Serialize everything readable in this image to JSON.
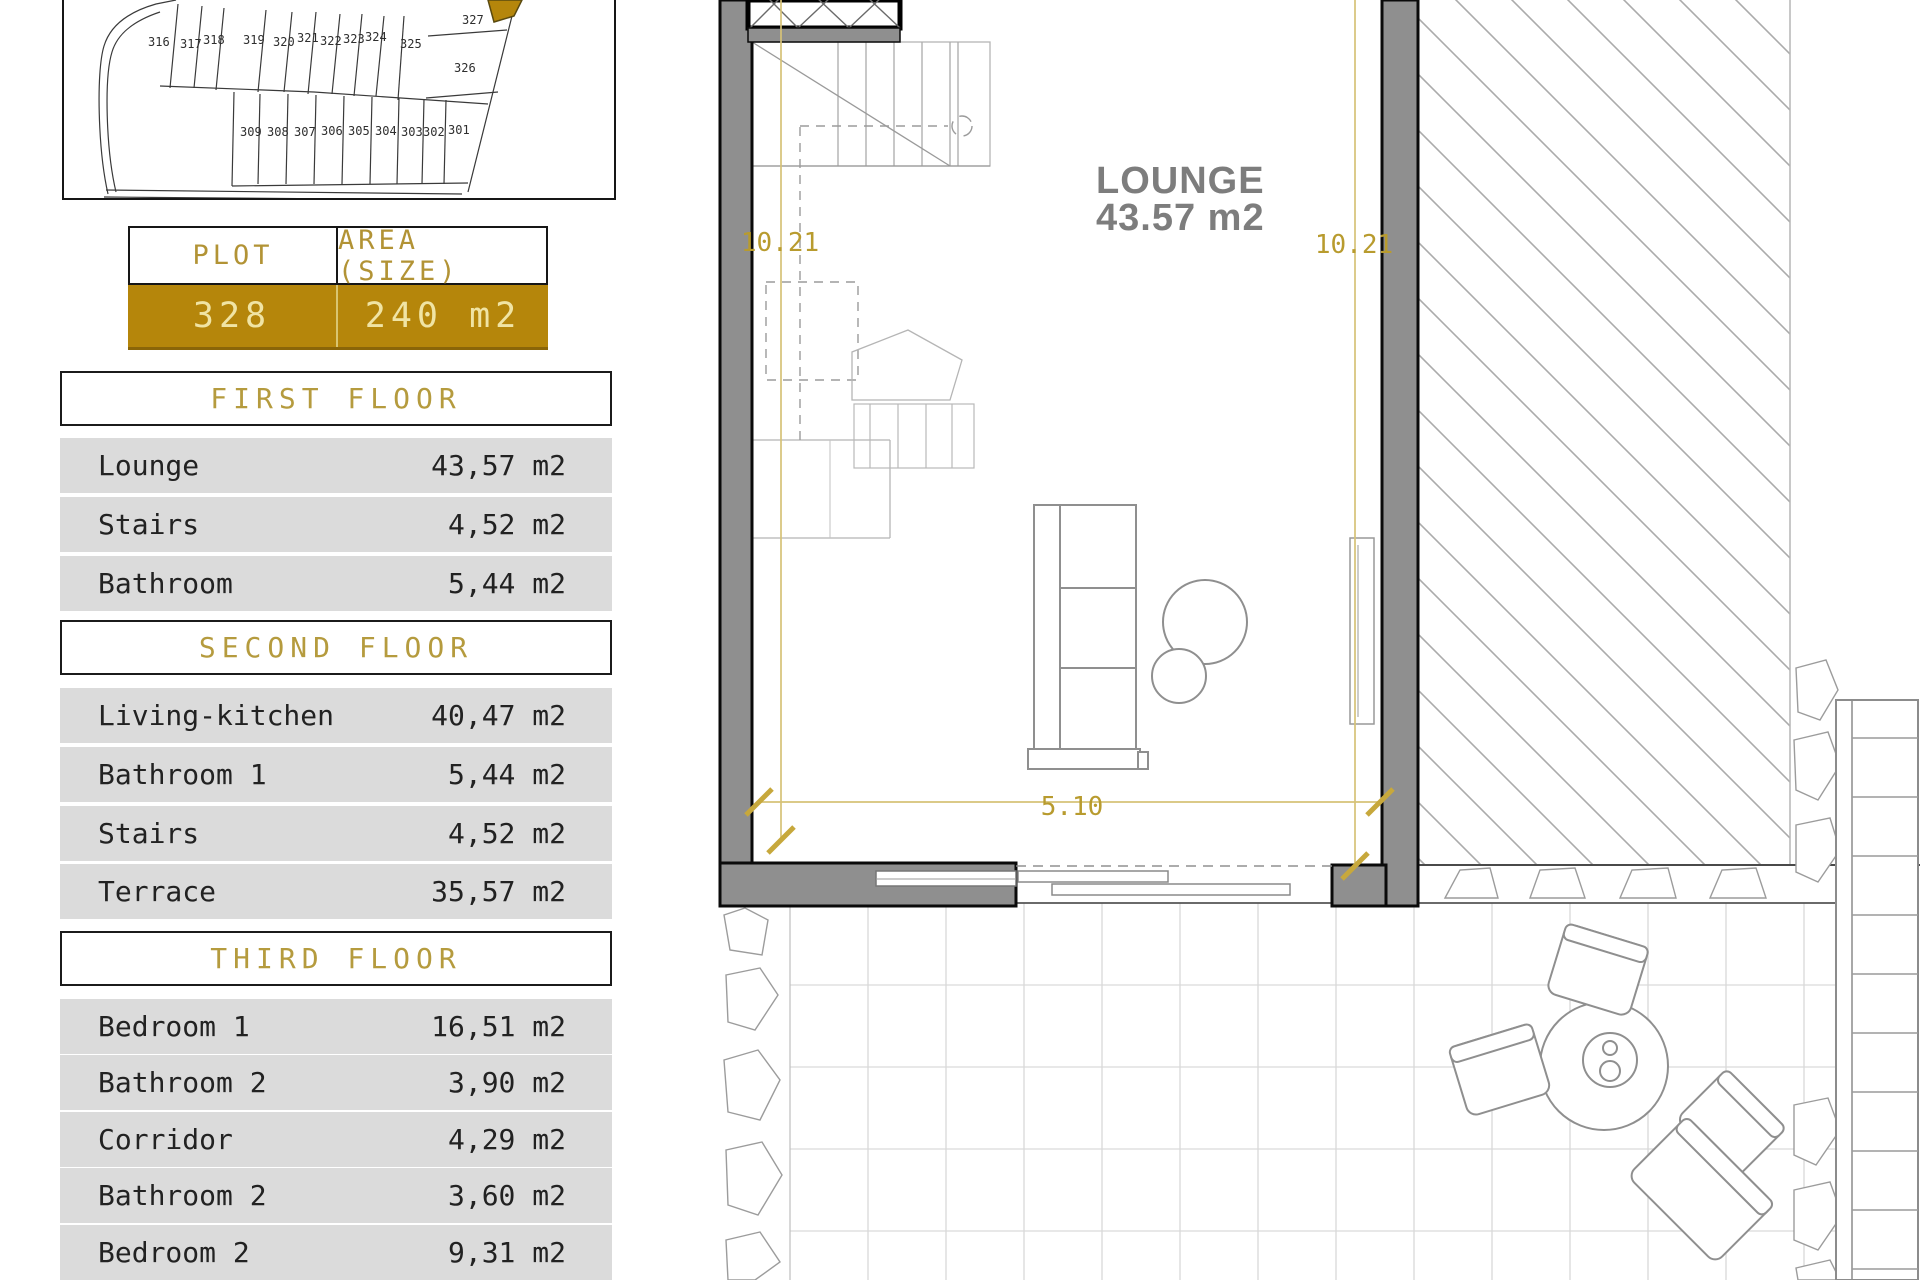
{
  "site_plan": {
    "plots_top": [
      "316",
      "317",
      "318",
      "319",
      "320",
      "321",
      "322",
      "323",
      "324",
      "325"
    ],
    "plots_right": [
      "327",
      "326"
    ],
    "plots_bottom": [
      "309",
      "308",
      "307",
      "306",
      "305",
      "304",
      "303",
      "302",
      "301"
    ],
    "highlight_color": "#b5860b"
  },
  "plot_table": {
    "col1_header": "PLOT",
    "col2_header": "AREA (SIZE)",
    "plot_number": "328",
    "plot_area": "240 m2",
    "gold": "#b5860b"
  },
  "floors": [
    {
      "title": "FIRST FLOOR",
      "rows": [
        {
          "label": "Lounge",
          "value": "43,57 m2"
        },
        {
          "label": "Stairs",
          "value": "4,52 m2"
        },
        {
          "label": "Bathroom",
          "value": "5,44 m2"
        }
      ]
    },
    {
      "title": "SECOND FLOOR",
      "rows": [
        {
          "label": "Living-kitchen",
          "value": "40,47 m2"
        },
        {
          "label": "Bathroom 1",
          "value": "5,44 m2"
        },
        {
          "label": "Stairs",
          "value": "4,52 m2"
        },
        {
          "label": "Terrace",
          "value": "35,57 m2"
        }
      ]
    },
    {
      "title": "THIRD FLOOR",
      "rows": [
        {
          "label": "Bedroom 1",
          "value": "16,51 m2"
        },
        {
          "label": "Bathroom 2",
          "value": "3,90 m2"
        },
        {
          "label": "Corridor",
          "value": "4,29 m2"
        },
        {
          "label": "Bathroom 2",
          "value": "3,60 m2"
        },
        {
          "label": "Bedroom 2",
          "value": "9,31 m2"
        }
      ]
    }
  ],
  "plan": {
    "room_label": "LOUNGE",
    "room_area": "43.57 m2",
    "dim_left": "10.21",
    "dim_right": "10.21",
    "dim_width": "5.10"
  }
}
